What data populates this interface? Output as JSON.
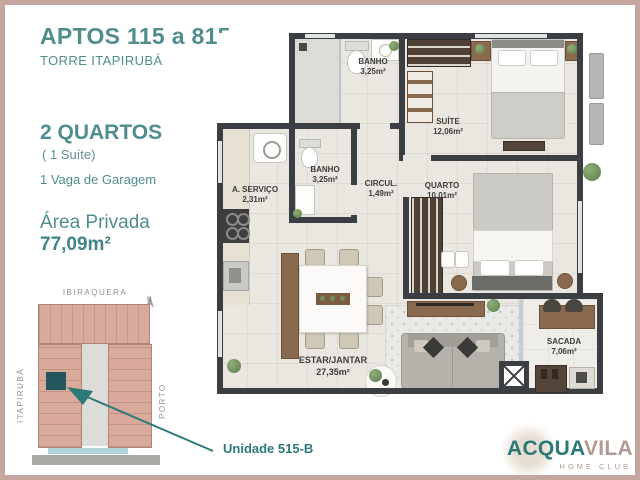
{
  "info_panel": {
    "title": "APTOS 115 a 815",
    "subtitle": "TORRE ITAPIRUBÁ",
    "bedrooms": "2 QUARTOS",
    "bedrooms_note": "( 1 Suíte)",
    "garage": "1 Vaga de Garagem",
    "area_label": "Área Privada",
    "area_value": "77,09m²"
  },
  "site_map": {
    "street_top": "IBIRAQUERA",
    "street_left": "ITAPIRUBÁ",
    "street_right": "PORTO",
    "compass_label": "N",
    "unit_callout": "Unidade 515-B"
  },
  "floor_plan": {
    "rooms": [
      {
        "name": "BANHO",
        "area": "3,25m²"
      },
      {
        "name": "SUÍTE",
        "area": "12,06m²"
      },
      {
        "name": "A. SERVIÇO",
        "area": "2,31m²"
      },
      {
        "name": "BANHO",
        "area": "3,25m²"
      },
      {
        "name": "CIRCUL.",
        "area": "1,49m²"
      },
      {
        "name": "QUARTO",
        "area": "10,01m²"
      },
      {
        "name": "ESTAR/JANTAR",
        "area": "27,35m²"
      },
      {
        "name": "SACADA",
        "area": "7,06m²"
      }
    ]
  },
  "logo": {
    "brand_part1": "ACQUA",
    "brand_part2": "VILA",
    "tagline": "HOME CLUB"
  },
  "colors": {
    "accent_teal": "#3f8584",
    "logo_teal": "#2c7a77",
    "logo_taupe": "#b29a93",
    "frame_border": "#c5a69e",
    "building_fill": "#d9aa9c",
    "unit_highlight": "#23575c",
    "wall": "#3b3e42"
  }
}
